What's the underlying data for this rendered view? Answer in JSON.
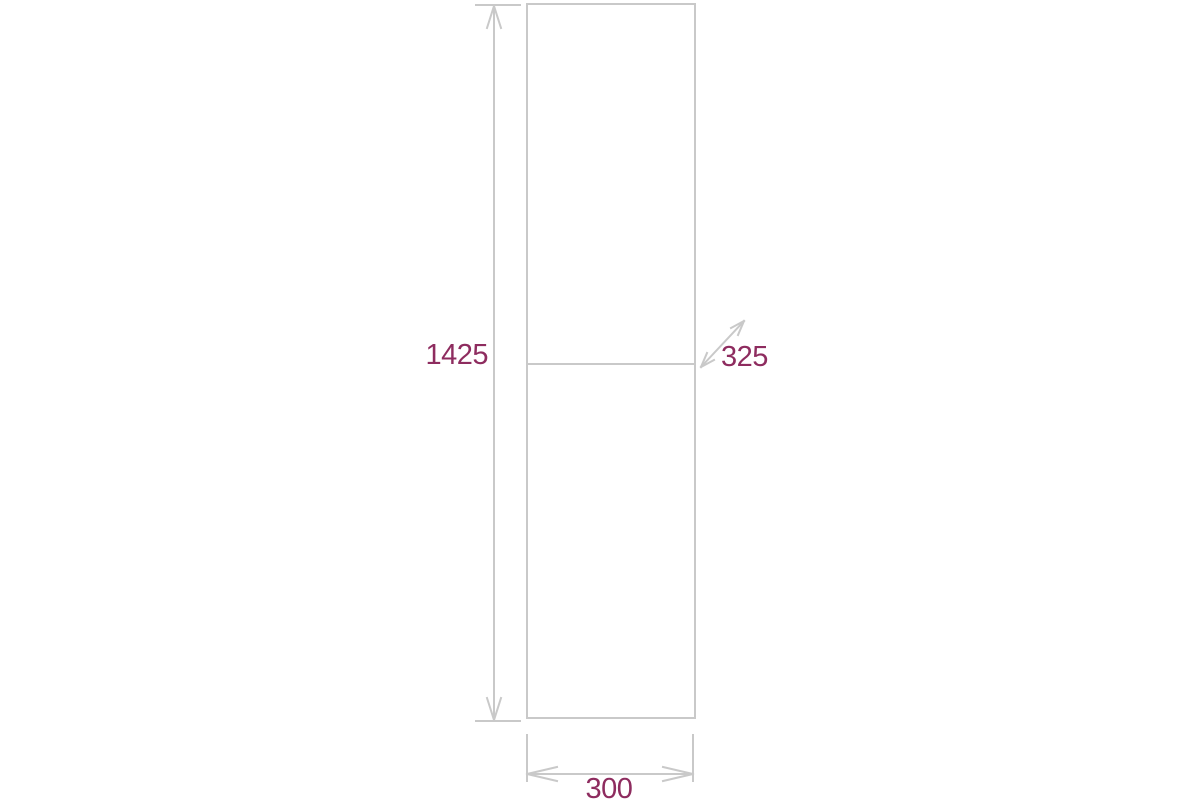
{
  "diagram": {
    "line_color": "#c9c9c9",
    "label_color": "#8e2c5f",
    "background_color": "#ffffff",
    "labels": {
      "height": "1425",
      "depth": "325",
      "width": "300"
    }
  }
}
